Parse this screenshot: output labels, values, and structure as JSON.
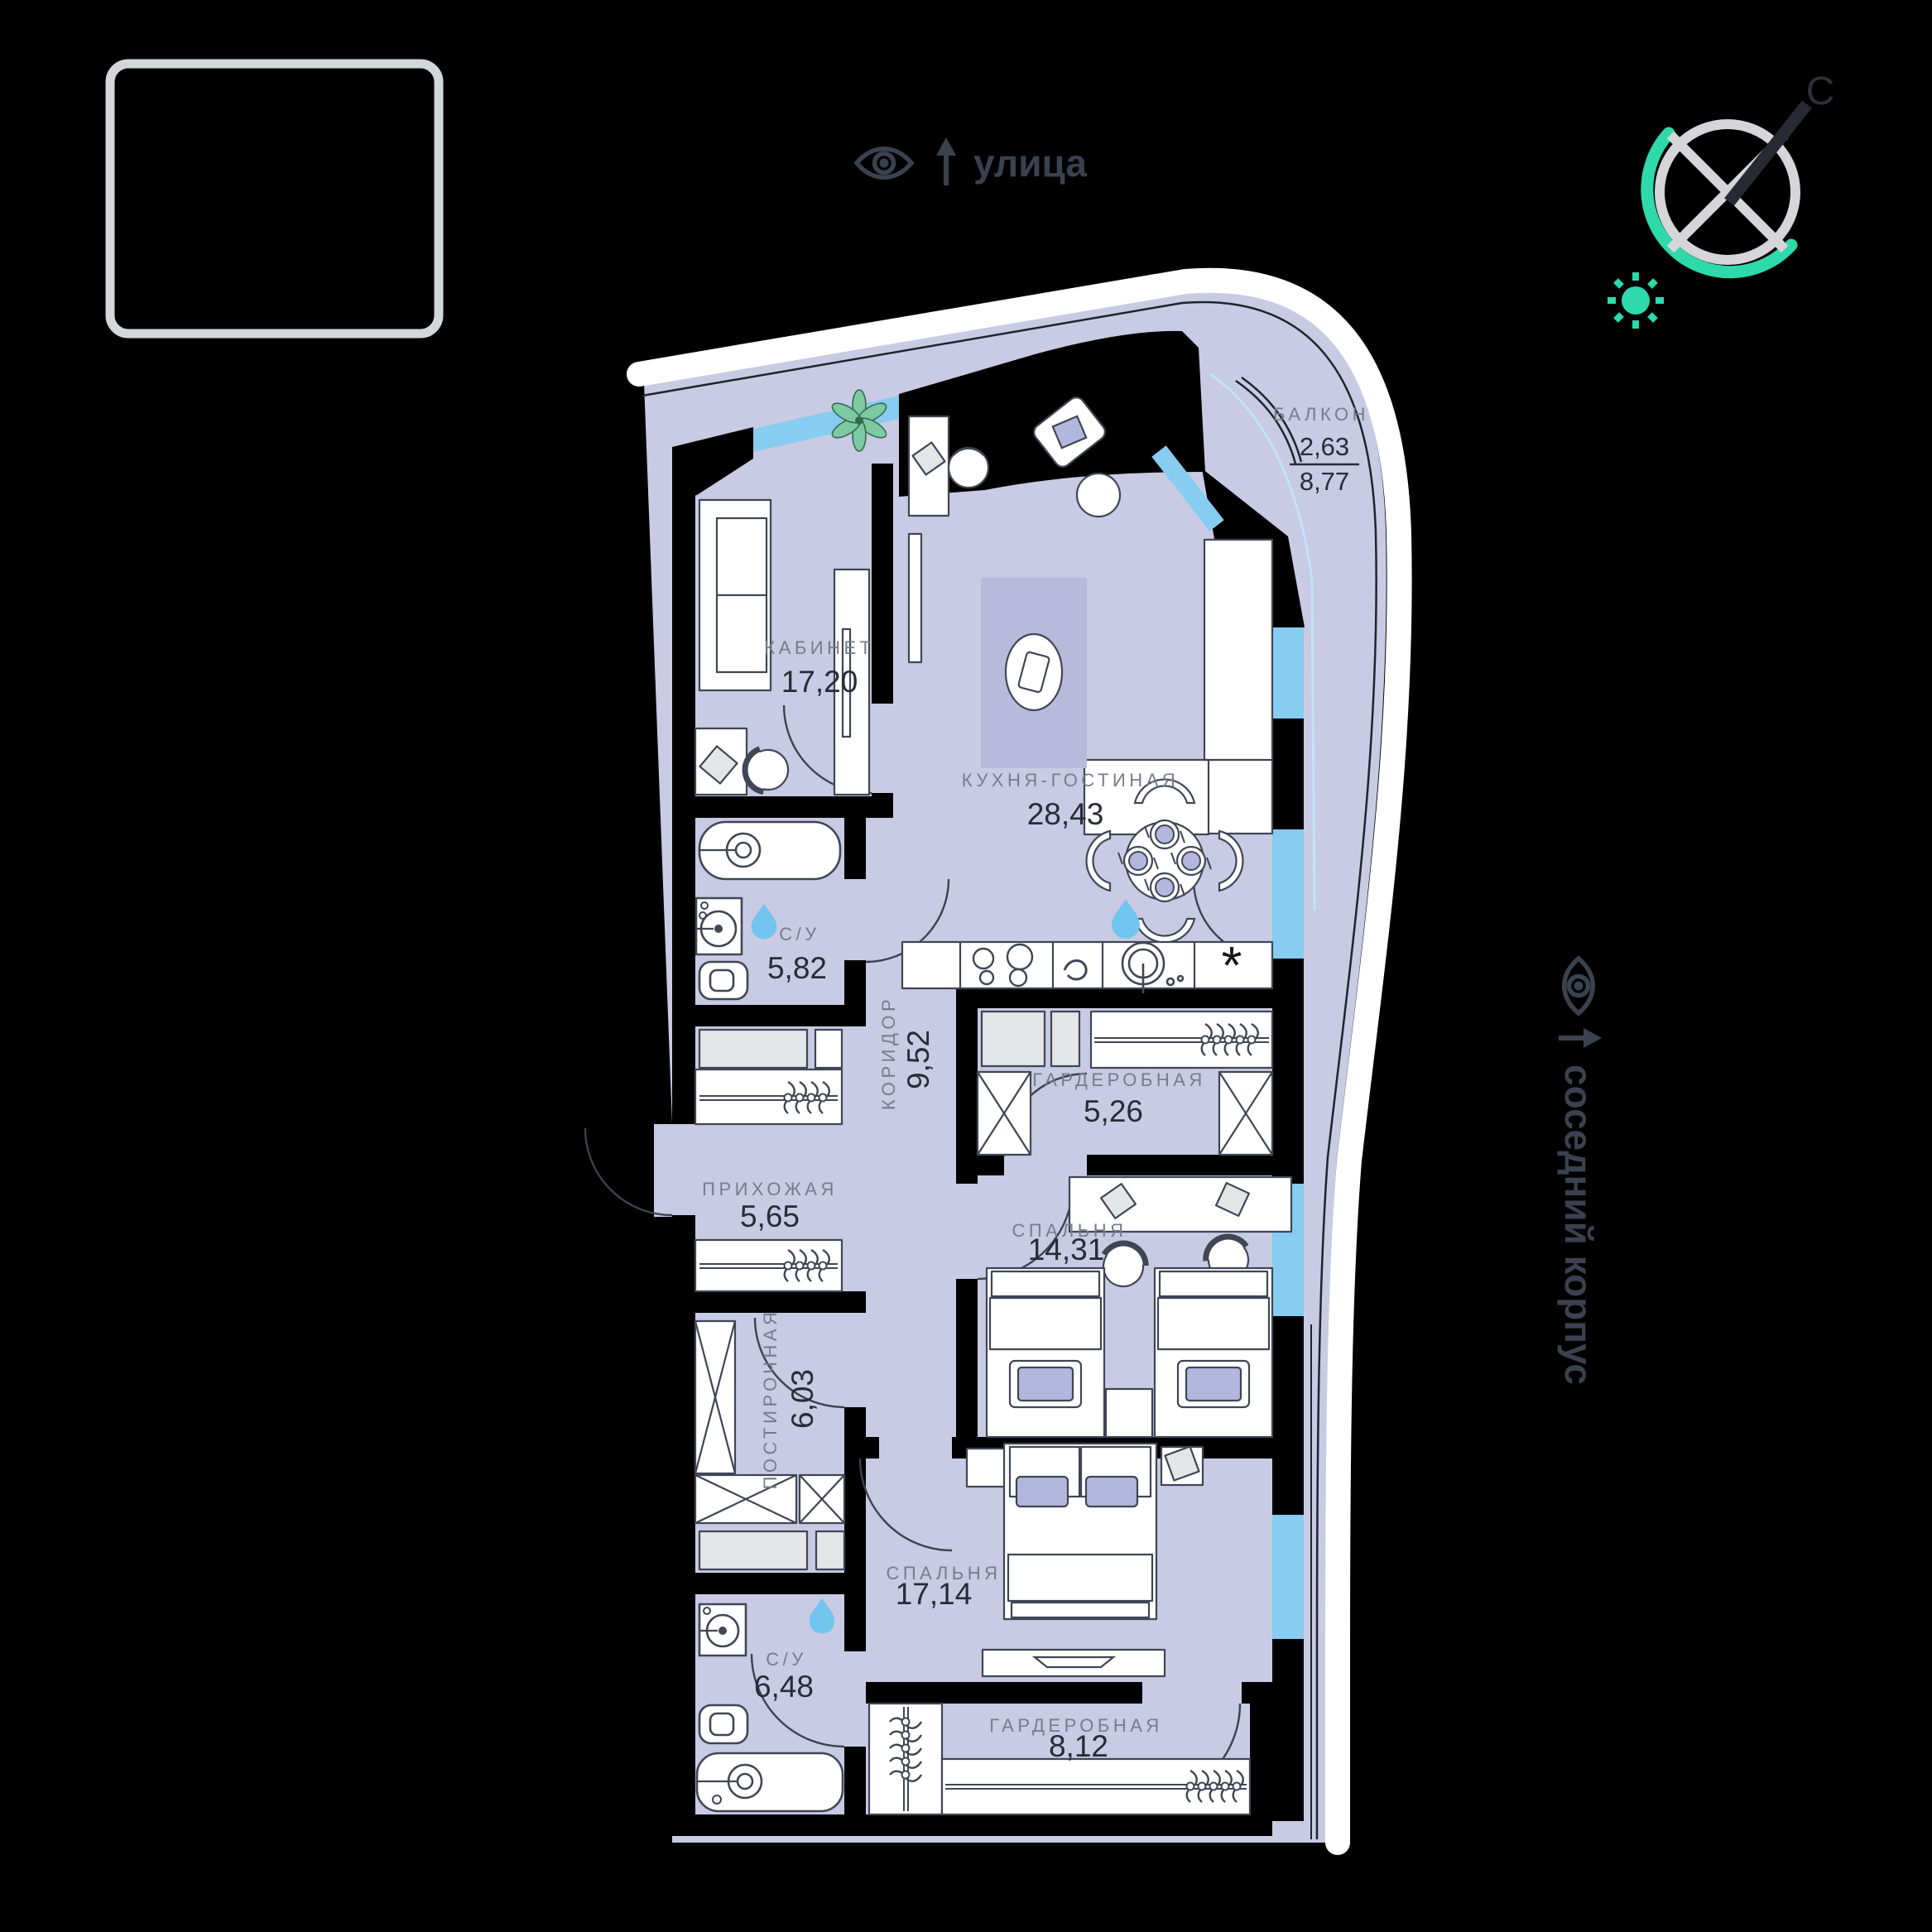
{
  "annotations": {
    "street": {
      "label": "улица"
    },
    "neighbor": {
      "label": "соседний корпус"
    },
    "north": {
      "label": "С"
    }
  },
  "rooms": [
    {
      "name": "КАБИНЕТ",
      "area": "17,20"
    },
    {
      "name": "КУХНЯ-ГОСТИНАЯ",
      "area": "28,43"
    },
    {
      "name": "БАЛКОН",
      "area_coeff": "2,63",
      "area_total": "8,77"
    },
    {
      "name": "С/У",
      "area": "5,82"
    },
    {
      "name": "КОРИДОР",
      "area": "9,52"
    },
    {
      "name": "ГАРДЕРОБНАЯ",
      "area": "5,26"
    },
    {
      "name": "ПРИХОЖАЯ",
      "area": "5,65"
    },
    {
      "name": "СПАЛЬНЯ",
      "area": "14,31"
    },
    {
      "name": "ПОСТИРОЧНАЯ",
      "area": "6,03"
    },
    {
      "name": "СПАЛЬНЯ",
      "area": "17,14"
    },
    {
      "name": "С/У",
      "area": "6,48"
    },
    {
      "name": "ГАРДЕРОБНАЯ",
      "area": "8,12"
    }
  ],
  "icons": {
    "kitchen_dishwasher": "*"
  },
  "colors": {
    "background": "#000000",
    "floor": "#c8cbe3",
    "rug": "#b7badb",
    "window_blue": "#87ccf1",
    "window_light": "#c3e3f9",
    "accent_teal": "#2ed9ab",
    "water_drop": "#72c5ee",
    "outer_band": "#ffffff",
    "label_gray": "#767c8c",
    "label_dark": "#272c37",
    "annotation_text": "#3a414f",
    "plant_green": "#7cc9a2"
  }
}
